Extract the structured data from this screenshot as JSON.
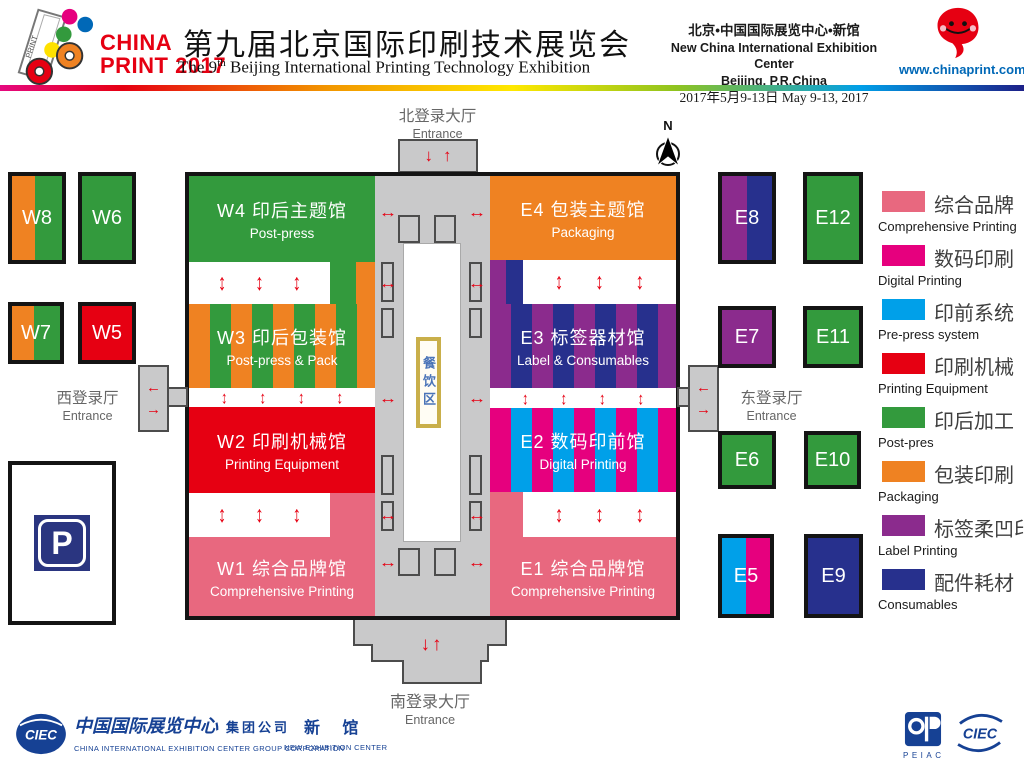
{
  "header": {
    "logo_line1": "CHINA",
    "logo_line2": "PRINT 2017",
    "title_cn": "第九届北京国际印刷技术展览会",
    "title_en_pre": "The 9",
    "title_en_sup": "th",
    "title_en_rest": " Beijing International Printing Technology Exhibition",
    "venue_cn": "北京•中国国际展览中心•新馆",
    "venue_en": "New China International Exhibition Center",
    "venue_city": "Beijing, P.R.China",
    "dates": "2017年5月9-13日 May 9-13, 2017",
    "website": "www.chinaprint.com.cn"
  },
  "map": {
    "entrances": {
      "north": {
        "cn": "北登录大厅",
        "en": "Entrance"
      },
      "south": {
        "cn": "南登录大厅",
        "en": "Entrance"
      },
      "west": {
        "cn": "西登录厅",
        "en": "Entrance"
      },
      "east": {
        "cn": "东登录厅",
        "en": "Entrance"
      }
    },
    "dining_label": "餐饮区",
    "compass_label": "N",
    "parking_label": "P",
    "halls": [
      {
        "id": "W4",
        "cn": "W4 印后主题馆",
        "en": "Post-press",
        "color": "#339a3d"
      },
      {
        "id": "W3",
        "cn": "W3 印后包装馆",
        "en": "Post-press & Pack",
        "colors": [
          "#ef8222",
          "#339a3d"
        ]
      },
      {
        "id": "W2",
        "cn": "W2 印刷机械馆",
        "en": "Printing Equipment",
        "color": "#e60012"
      },
      {
        "id": "W1",
        "cn": "W1 综合品牌馆",
        "en": "Comprehensive Printing",
        "color": "#e8687f"
      },
      {
        "id": "E4",
        "cn": "E4 包装主题馆",
        "en": "Packaging",
        "color": "#ef8222"
      },
      {
        "id": "E3",
        "cn": "E3 标签器材馆",
        "en": "Label & Consumables",
        "colors": [
          "#8b2b8d",
          "#27308d"
        ]
      },
      {
        "id": "E2",
        "cn": "E2 数码印前馆",
        "en": "Digital Printing",
        "colors": [
          "#e6007e",
          "#00a0e9"
        ]
      },
      {
        "id": "E1",
        "cn": "E1 综合品牌馆",
        "en": "Comprehensive Printing",
        "color": "#e8687f"
      }
    ],
    "satellites": [
      {
        "id": "W8",
        "colors": [
          "#ef8222",
          "#339a3d"
        ]
      },
      {
        "id": "W6",
        "colors": [
          "#339a3d"
        ]
      },
      {
        "id": "W7",
        "colors": [
          "#ef8222",
          "#339a3d"
        ]
      },
      {
        "id": "W5",
        "colors": [
          "#e60012"
        ]
      },
      {
        "id": "E8",
        "colors": [
          "#8b2b8d",
          "#27308d"
        ]
      },
      {
        "id": "E12",
        "colors": [
          "#339a3d"
        ]
      },
      {
        "id": "E7",
        "colors": [
          "#8b2b8d"
        ]
      },
      {
        "id": "E11",
        "colors": [
          "#339a3d"
        ]
      },
      {
        "id": "E6",
        "colors": [
          "#339a3d"
        ]
      },
      {
        "id": "E10",
        "colors": [
          "#339a3d"
        ]
      },
      {
        "id": "E5",
        "colors": [
          "#00a0e9",
          "#e6007e"
        ]
      },
      {
        "id": "E9",
        "colors": [
          "#27308d"
        ]
      }
    ]
  },
  "legend": [
    {
      "cn": "综合品牌",
      "en": "Comprehensive Printing",
      "color": "#e8687f"
    },
    {
      "cn": "数码印刷",
      "en": "Digital Printing",
      "color": "#e6007e"
    },
    {
      "cn": "印前系统",
      "en": "Pre-press system",
      "color": "#00a0e9"
    },
    {
      "cn": "印刷机械",
      "en": "Printing Equipment",
      "color": "#e60012"
    },
    {
      "cn": "印后加工",
      "en": "Post-pres",
      "color": "#339a3d"
    },
    {
      "cn": "包装印刷",
      "en": "Packaging",
      "color": "#ef8222"
    },
    {
      "cn": "标签柔凹印",
      "en": "Label Printing",
      "color": "#8b2b8d"
    },
    {
      "cn": "配件耗材",
      "en": "Consumables",
      "color": "#27308d"
    }
  ],
  "icons": {
    "updown": "↕",
    "leftright": "↔",
    "left": "←",
    "right": "→",
    "down": "↓",
    "up": "↑",
    "down_up": "↓↑"
  },
  "footer": {
    "ciec_logo": "CIEC",
    "group_cn": "中国国际展览中心",
    "group_suffix": "集团公司",
    "group_en": "CHINA INTERNATIONAL EXHIBITION CENTER GROUP CORPORATION",
    "new_cn": "新 馆",
    "new_en": "NEW EXHIBITION CENTER",
    "peiac": "PEIAC",
    "ciec_logo_right": "CIEC"
  }
}
